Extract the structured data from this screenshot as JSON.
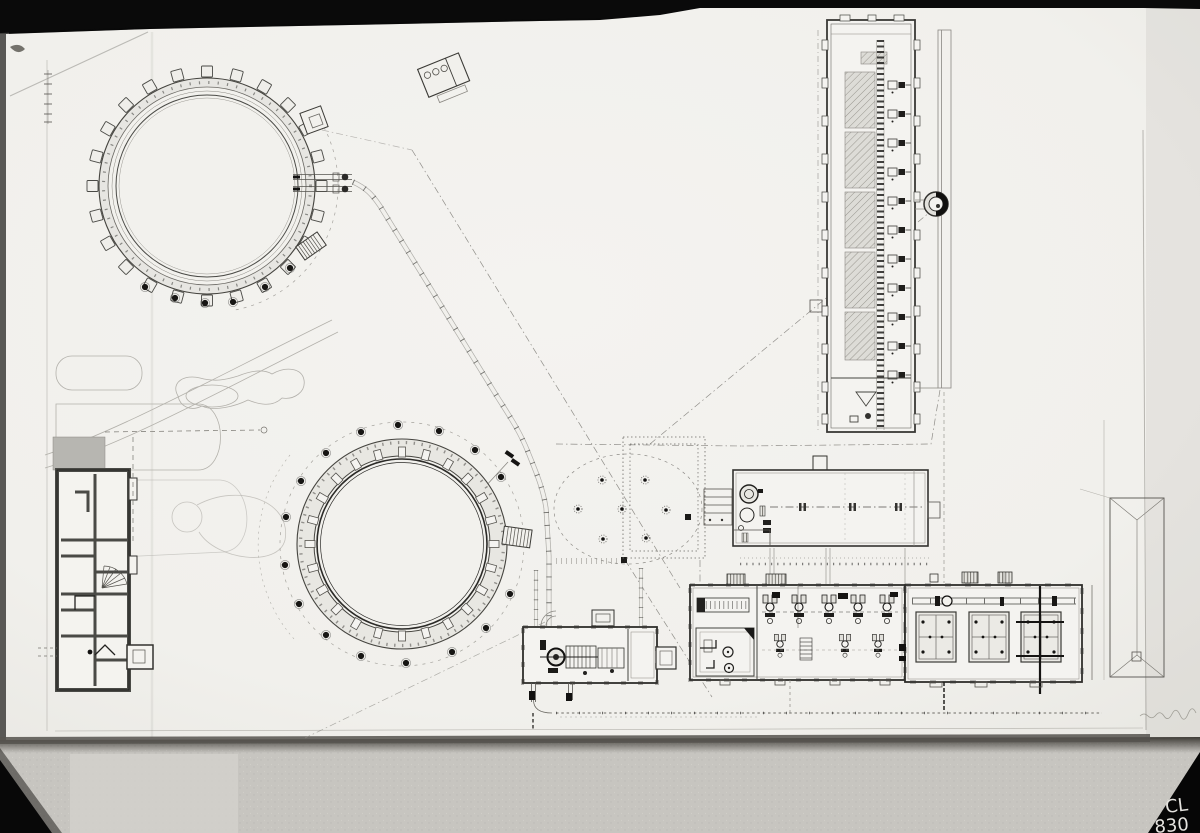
{
  "photo": {
    "corner_label": {
      "line1": "CL",
      "line2": "830"
    }
  },
  "colors": {
    "photo_black": "#0a0a0a",
    "mat_gray": "#c7c5c0",
    "paper_white": "#f2f1ed",
    "ink_dark": "#2f2e2b",
    "ink_mid": "#55534e",
    "ink_faint": "#9a9892",
    "wall_fill": "#e8e7e2",
    "hatch_fill": "#dddcd7",
    "label_white": "#e4e2de"
  },
  "icons": {
    "tree-icon": "filled dot with halo ring",
    "stairs-icon": "ladder rungs",
    "valve-icon": "paired dark blocks on pipe"
  }
}
